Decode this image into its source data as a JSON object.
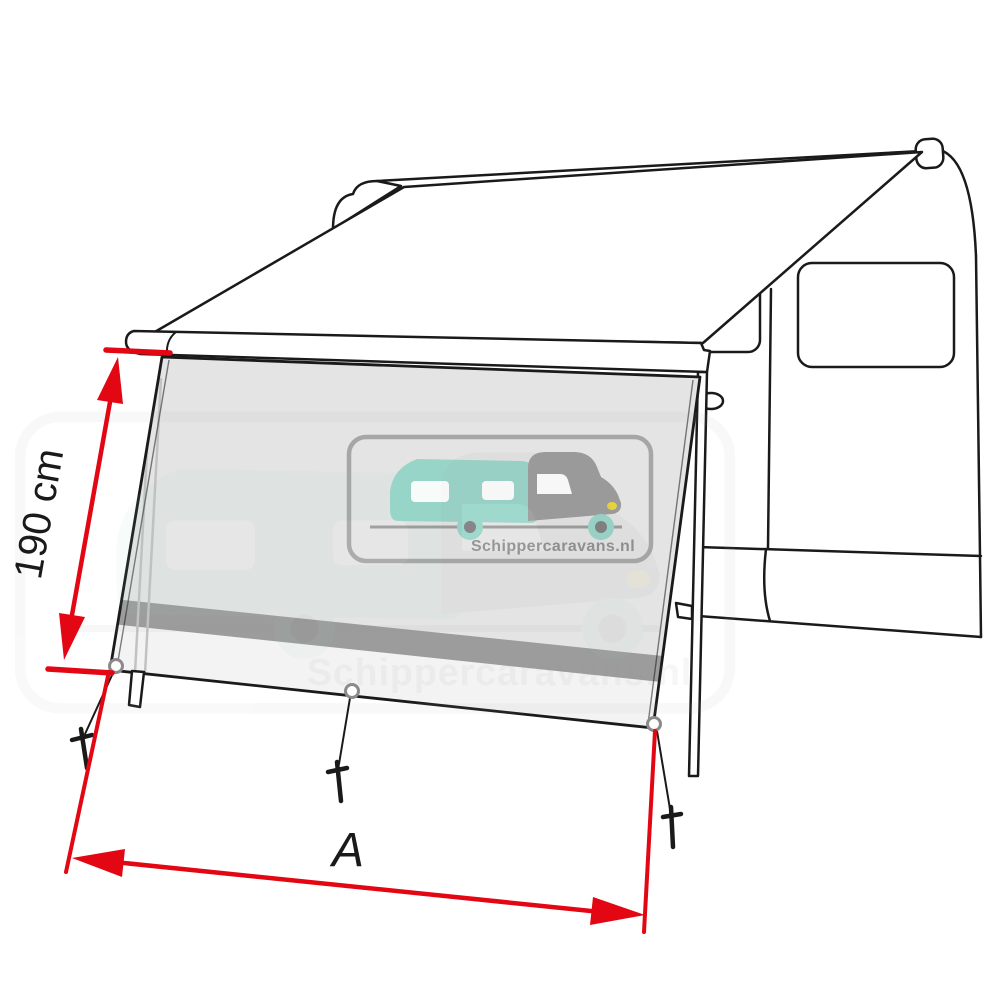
{
  "figure": {
    "type": "product dimension diagram",
    "subject": "Awning front sun-shade panel mounted on a motorhome awning",
    "dimensions": {
      "height_label": "190 cm",
      "width_label": "A"
    },
    "watermark": {
      "text": "Schippercaravans.nl"
    },
    "colors": {
      "dimension_red": "#e30613",
      "outline_black": "#1a1a1a",
      "panel_gray": "#e4e4e4",
      "panel_band_gray": "#9c9c9c",
      "panel_bottom_strip": "#f3f3f3",
      "watermark_teal": "#98d5c9",
      "watermark_gray": "#9a9a9a",
      "headlight_yellow": "#e6d23e"
    }
  }
}
